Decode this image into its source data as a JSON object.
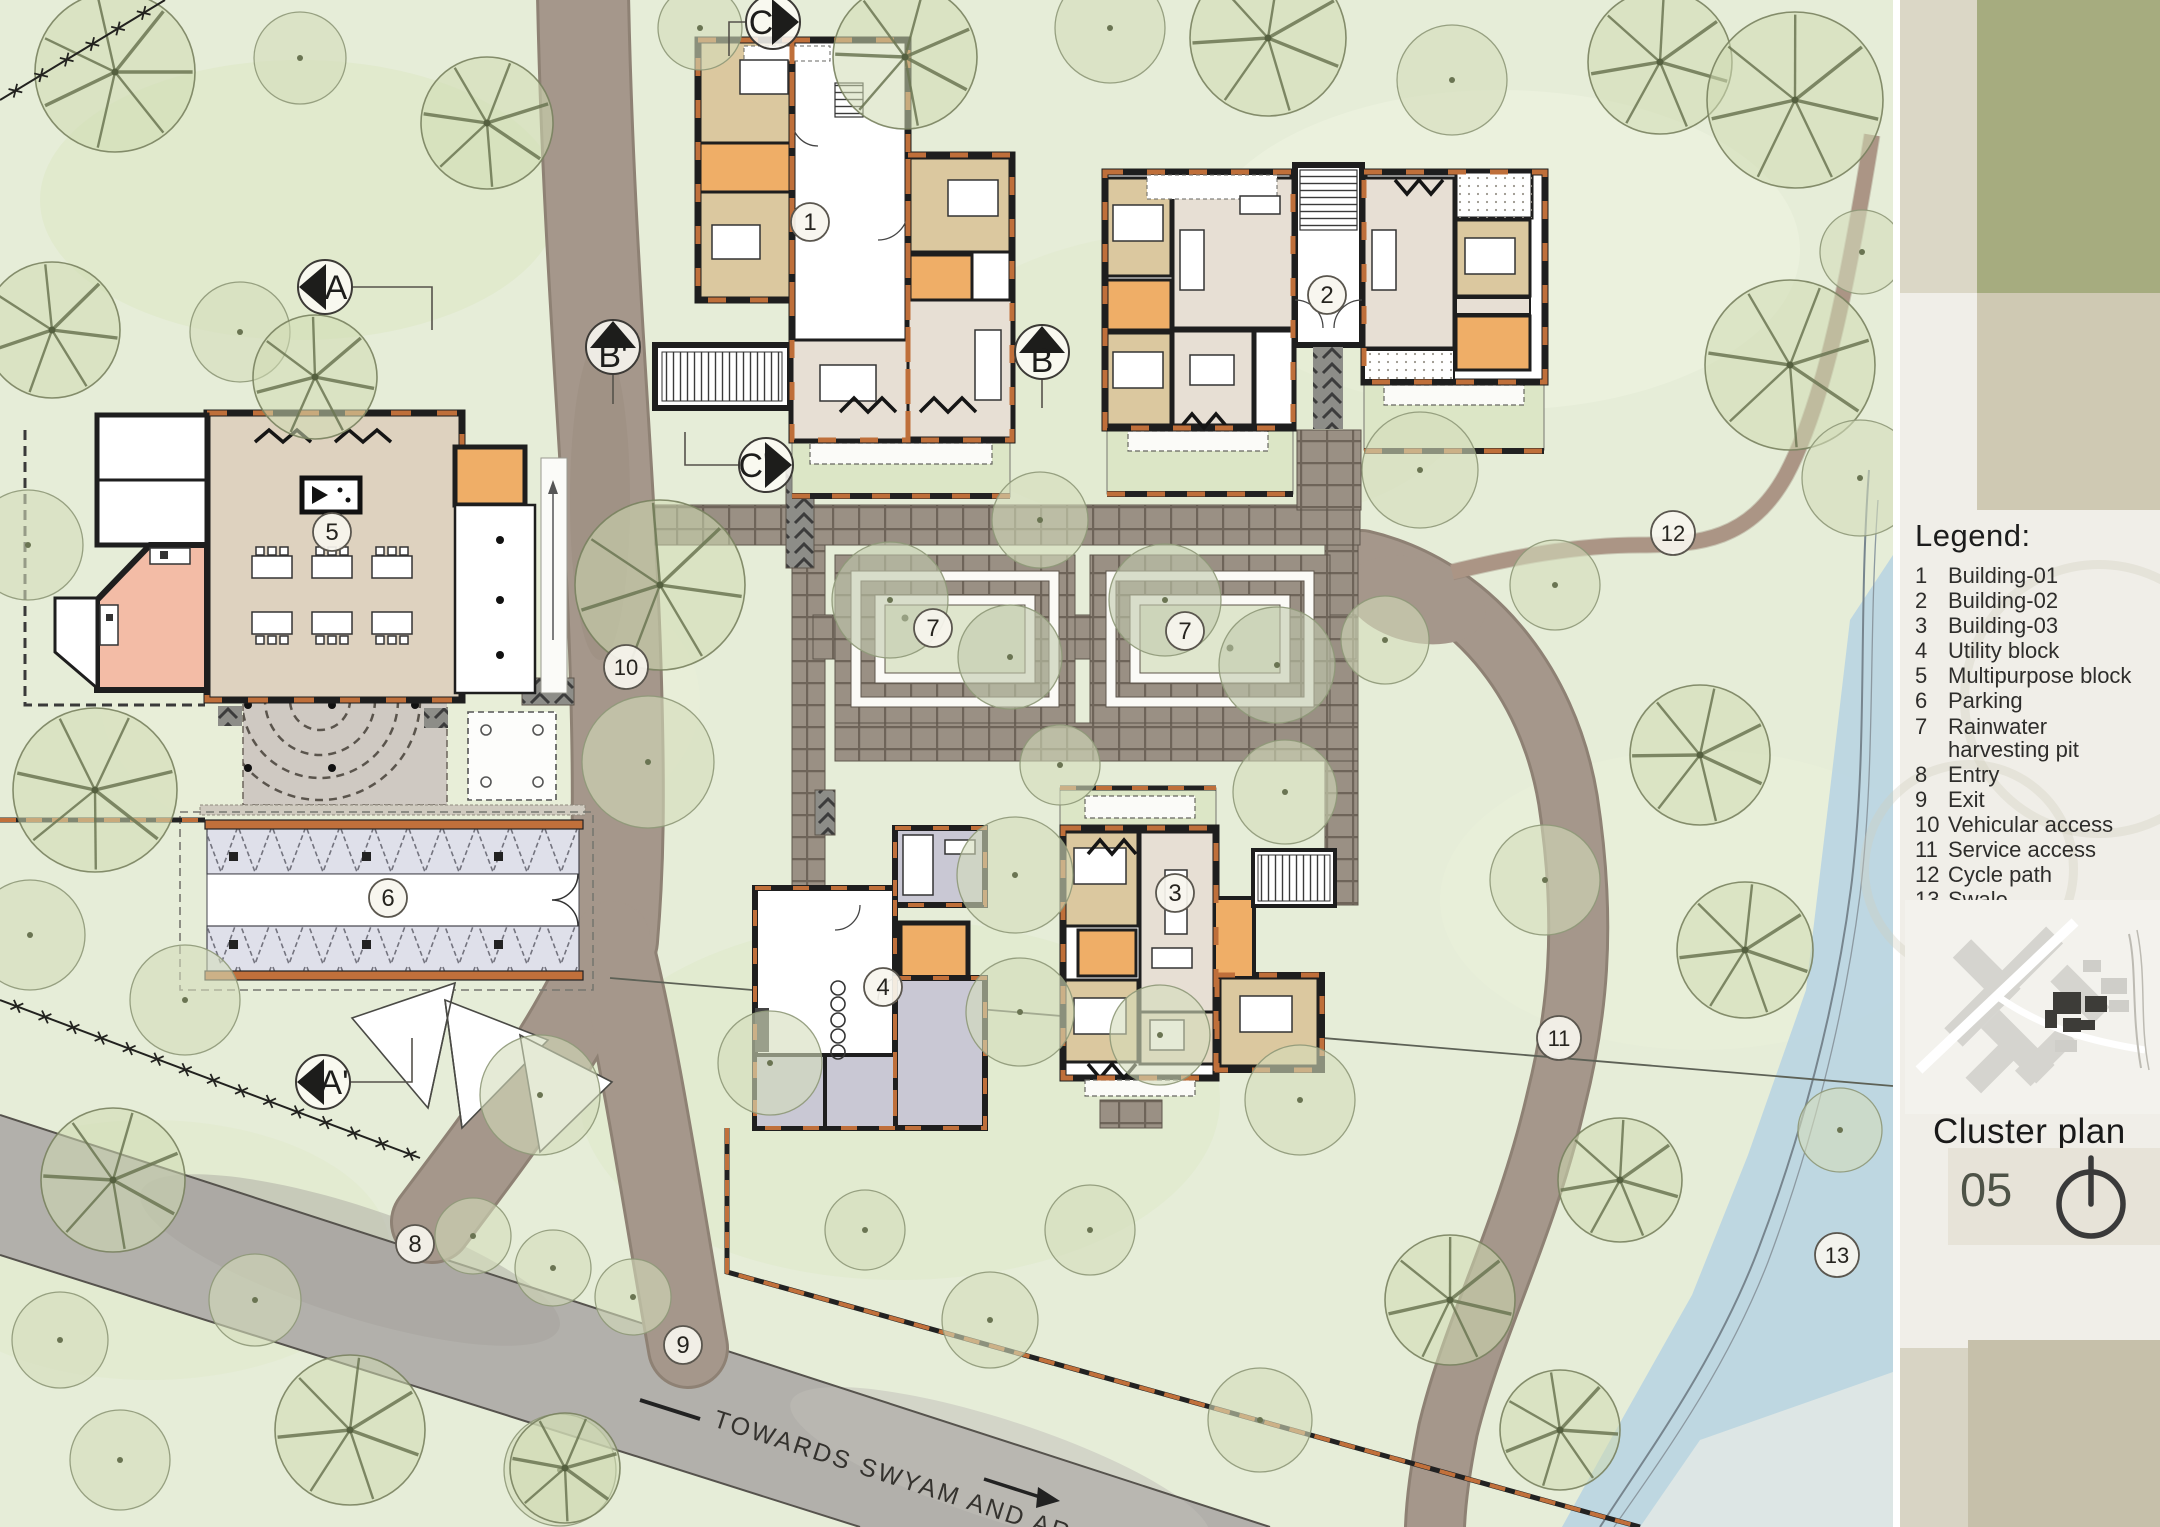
{
  "legend": {
    "title": "Legend:",
    "items": [
      {
        "num": "1",
        "label": "Building-01"
      },
      {
        "num": "2",
        "label": "Building-02"
      },
      {
        "num": "3",
        "label": "Building-03"
      },
      {
        "num": "4",
        "label": "Utility block"
      },
      {
        "num": "5",
        "label": "Multipurpose block"
      },
      {
        "num": "6",
        "label": "Parking"
      },
      {
        "num": "7",
        "label": "Rainwater harvesting pit"
      },
      {
        "num": "8",
        "label": "Entry"
      },
      {
        "num": "9",
        "label": "Exit"
      },
      {
        "num": "10",
        "label": "Vehicular access"
      },
      {
        "num": "11",
        "label": "Service access"
      },
      {
        "num": "12",
        "label": "Cycle path"
      },
      {
        "num": "13",
        "label": "Swale"
      }
    ]
  },
  "sheet": {
    "title": "Cluster plan",
    "number": "05",
    "north_icon": "north-arrow"
  },
  "road_label": {
    "text": "TOWARDS SWYAM AND ARATI"
  },
  "markers": {
    "numbered": [
      {
        "label": "1"
      },
      {
        "label": "2"
      },
      {
        "label": "3"
      },
      {
        "label": "4"
      },
      {
        "label": "5"
      },
      {
        "label": "6"
      },
      {
        "label": "7"
      },
      {
        "label": "8"
      },
      {
        "label": "9"
      },
      {
        "label": "10"
      },
      {
        "label": "11"
      },
      {
        "label": "12"
      },
      {
        "label": "13"
      }
    ],
    "sections": [
      {
        "label": "A"
      },
      {
        "label": "A'"
      },
      {
        "label": "B'"
      },
      {
        "label": "B"
      },
      {
        "label": "C"
      },
      {
        "label": "C'"
      }
    ]
  }
}
